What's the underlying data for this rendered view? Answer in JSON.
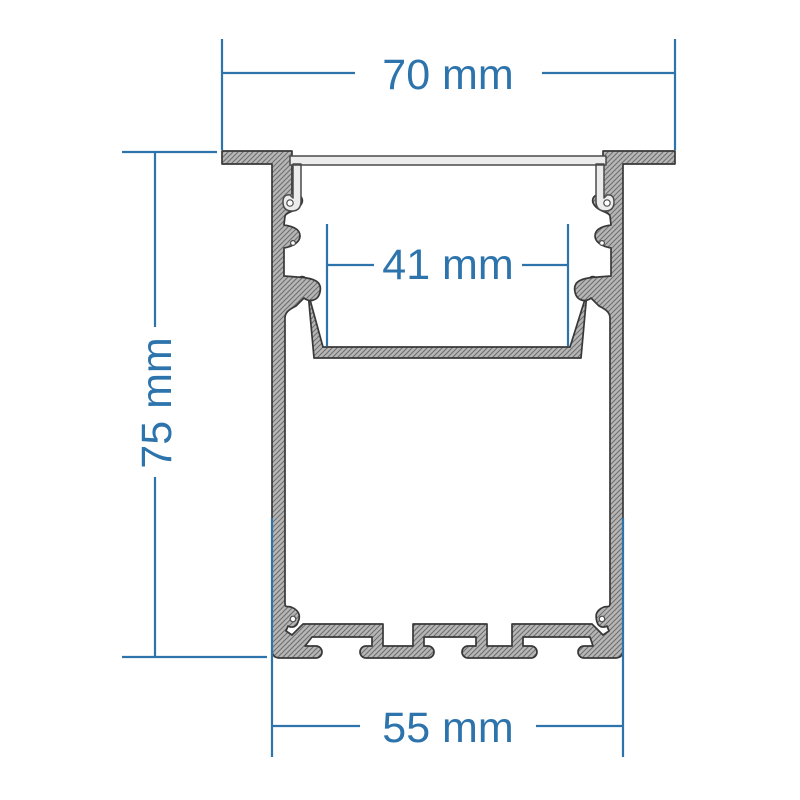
{
  "drawing": {
    "type": "aluminium-led-profile-cross-section",
    "labels": {
      "top_width": "70 mm",
      "inner_width": "41 mm",
      "height": "75 mm",
      "bottom_width": "55 mm"
    },
    "colors": {
      "dimension_blue": "#2e74ac",
      "aluminum_gray": "#b6b6b6",
      "hatch_line_gray": "#6e6e6e",
      "outline_dark": "#383838",
      "diffuser_light": "#ececec",
      "background": "#ffffff"
    }
  }
}
